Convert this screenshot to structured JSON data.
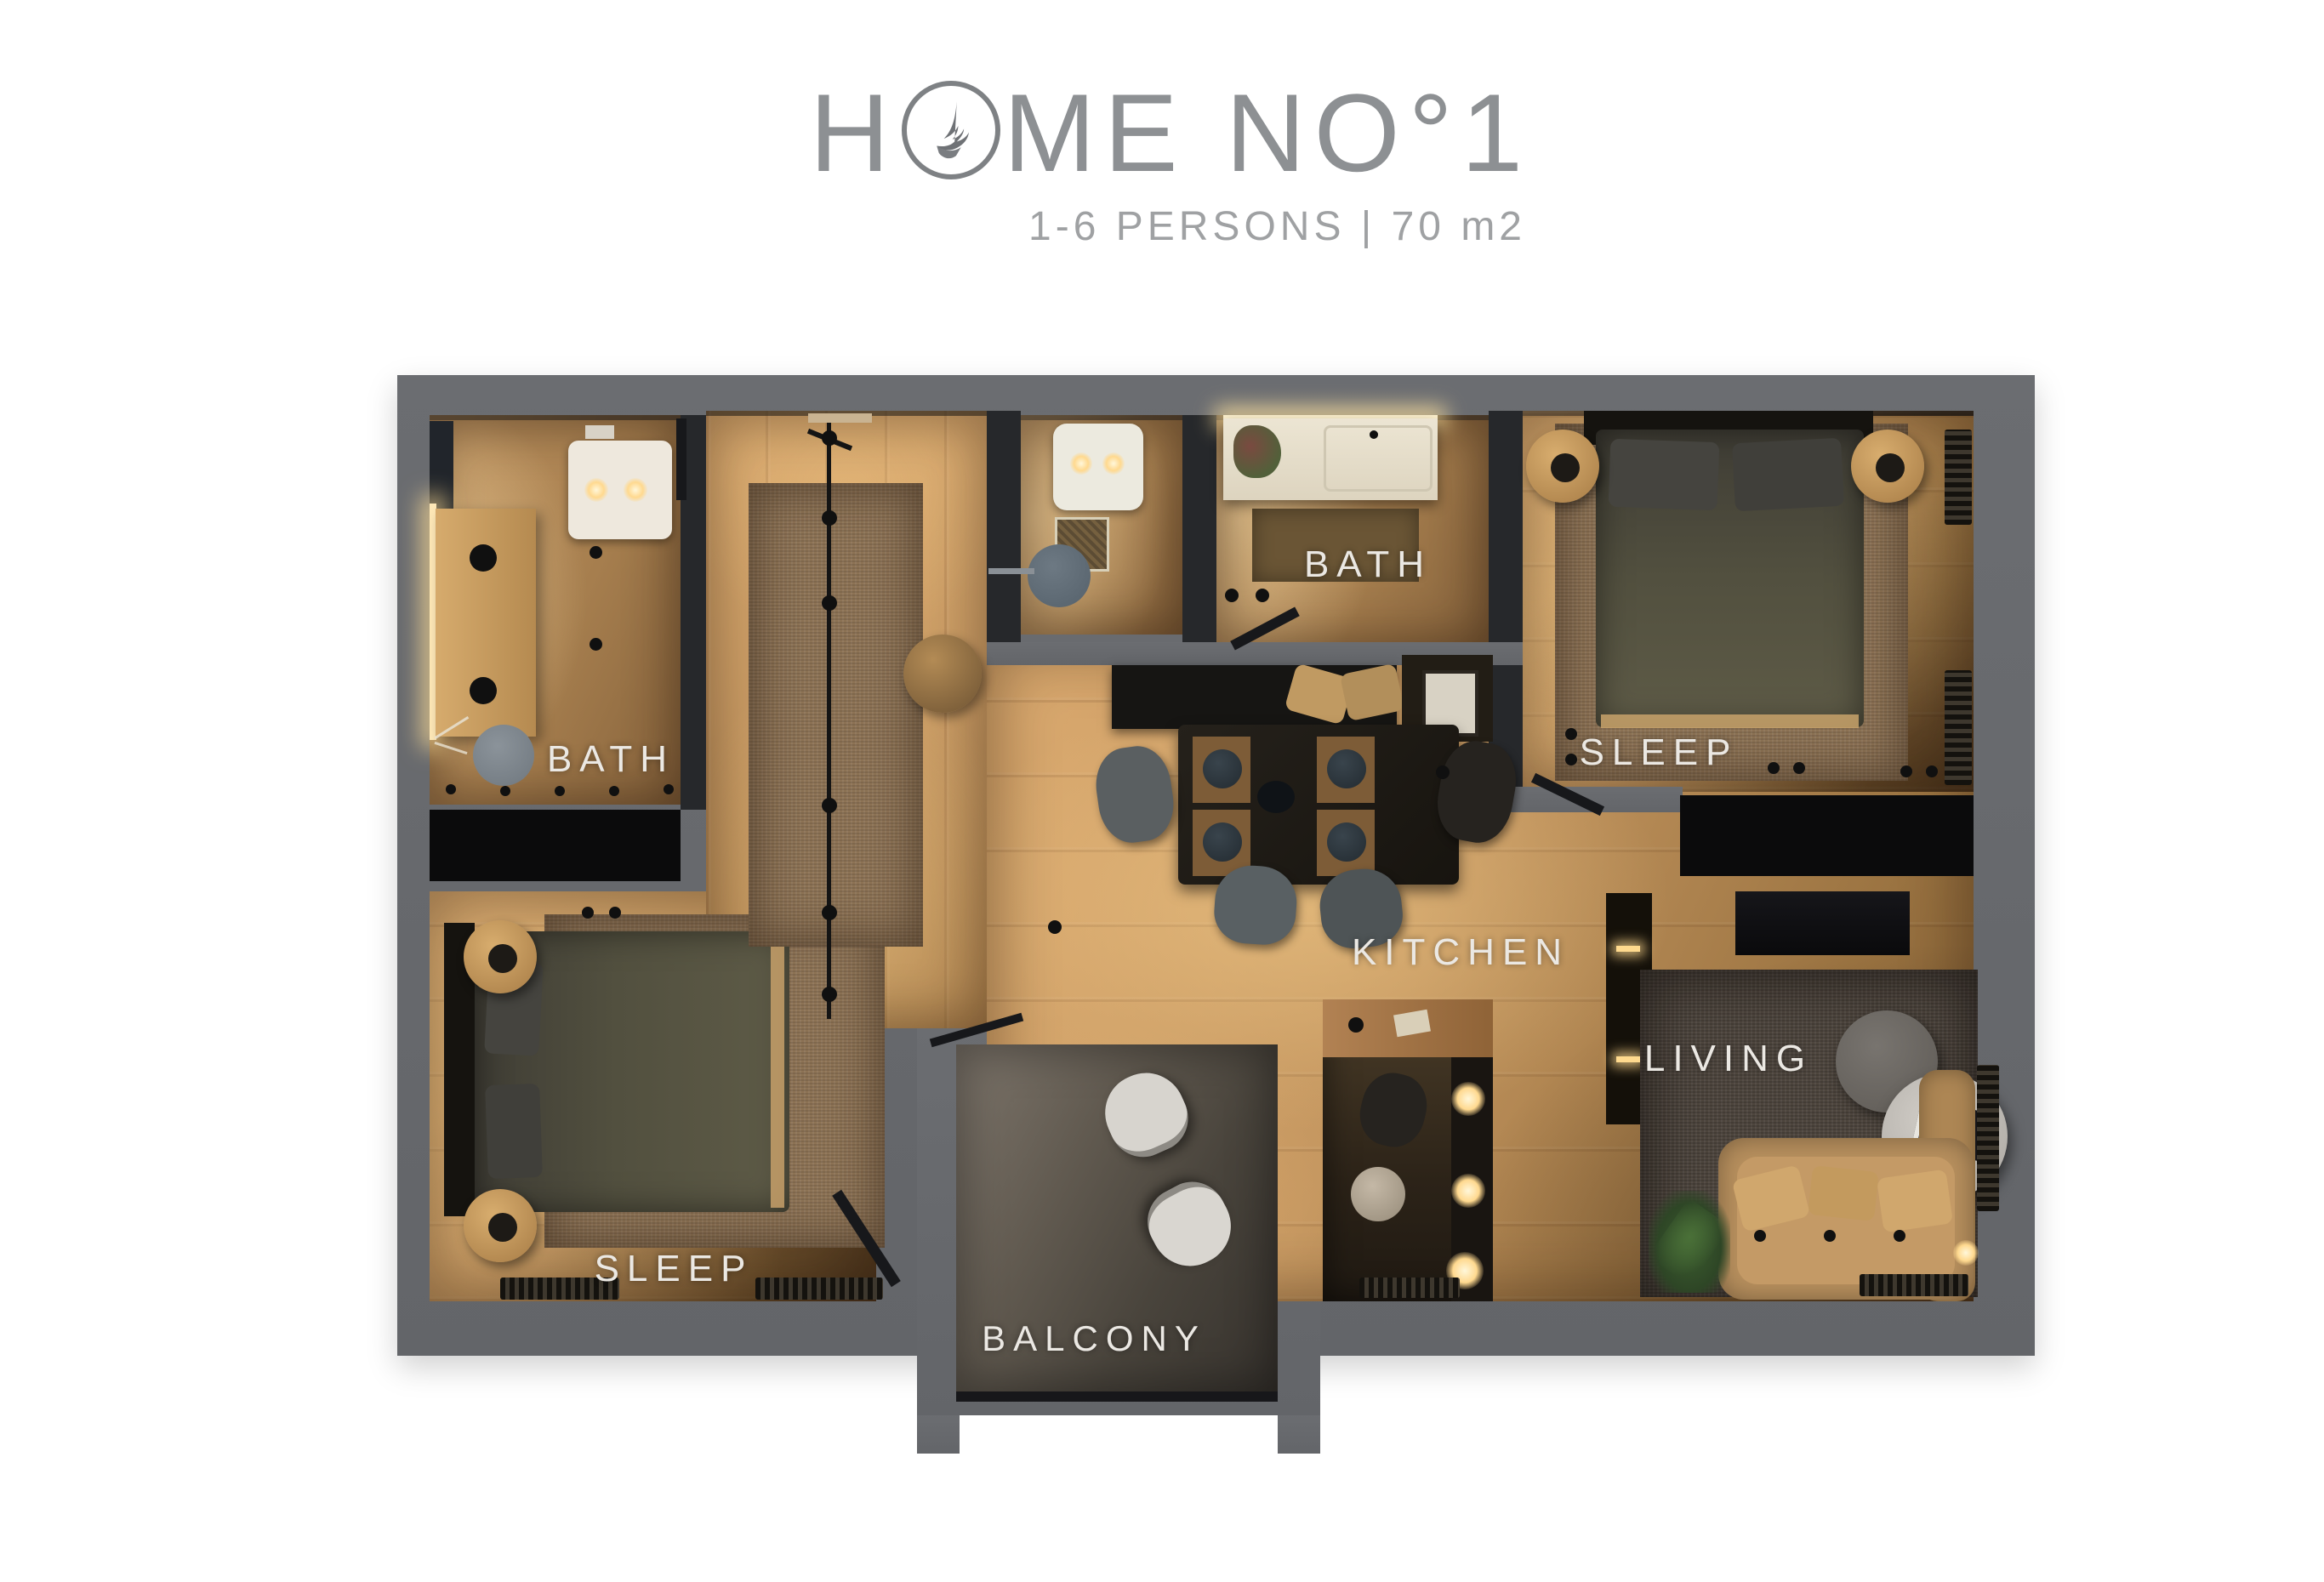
{
  "header": {
    "title_prefix": "H",
    "title_suffix": "ME NO°1",
    "subtitle": "1-6 PERSONS | 70 m2",
    "logo": "eagle-feather-logo"
  },
  "rooms": {
    "bath_left": "BATH",
    "bath_top": "BATH",
    "sleep_right": "SLEEP",
    "sleep_left": "SLEEP",
    "kitchen": "KITCHEN",
    "living": "LIVING",
    "balcony": "BALCONY"
  },
  "colors": {
    "title_gray": "#8d9093",
    "subtitle_gray": "#9fa1a3",
    "wall_gray": "#686a6e",
    "label_white": "#ebe8e3",
    "wood_light": "#e8ba7d",
    "wood_dark": "#8a6236",
    "bath_floor_tan": "#ab8656",
    "rug_brown": "#8d7355",
    "rug_dark": "#4a433c",
    "furniture_black": "#151413",
    "bedding_olive": "#53513f",
    "sofa_tan": "#b8905e",
    "glow_warm": "#ffd98f"
  }
}
